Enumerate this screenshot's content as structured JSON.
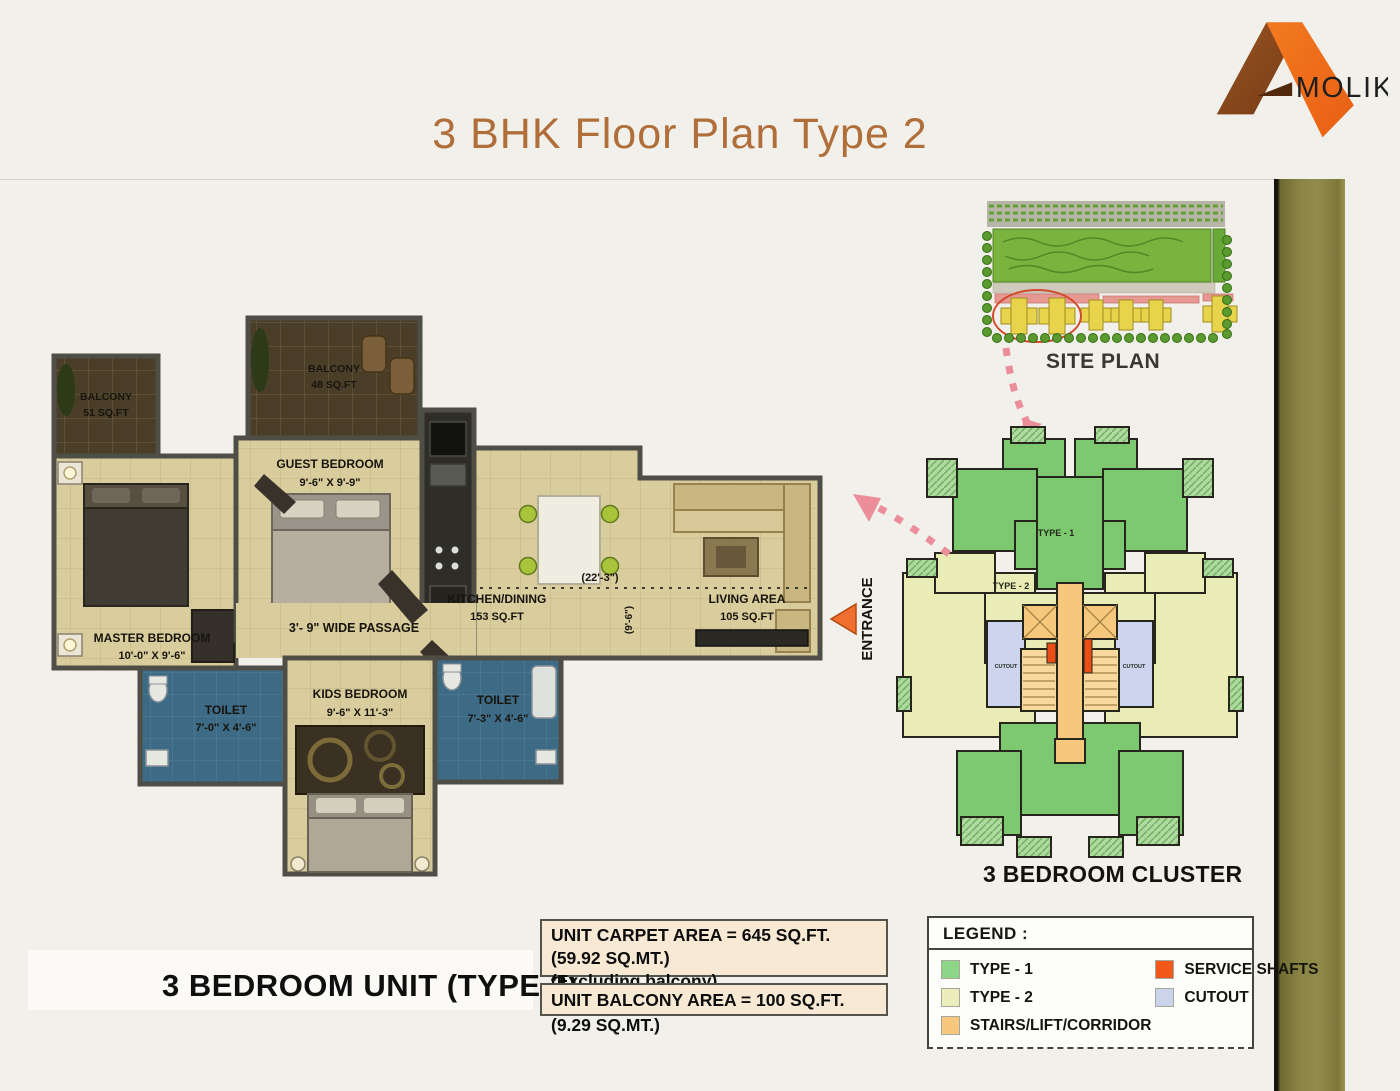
{
  "header": {
    "title": "3 BHK Floor Plan Type 2",
    "brand": "MOLIK"
  },
  "floor_plan": {
    "unit_label": "3 BEDROOM UNIT (TYPE 2)",
    "entrance_label": "ENTRANCE",
    "passage_label": "3'- 9\" WIDE PASSAGE",
    "width_dim": "(22'-3\")",
    "depth_dim": "(9'-6\")",
    "rooms": {
      "balcony_left": {
        "name": "BALCONY",
        "size": "51 SQ.FT"
      },
      "balcony_top": {
        "name": "BALCONY",
        "size": "48 SQ.FT"
      },
      "master_bedroom": {
        "name": "MASTER BEDROOM",
        "size": "10'-0\" X 9'-6\""
      },
      "guest_bedroom": {
        "name": "GUEST BEDROOM",
        "size": "9'-6\" X 9'-9\""
      },
      "kitchen_dining": {
        "name": "KITCHEN/DINING",
        "size": "153 SQ.FT"
      },
      "living_area": {
        "name": "LIVING AREA",
        "size": "105 SQ.FT"
      },
      "toilet_left": {
        "name": "TOILET",
        "size": "7'-0\" X 4'-6\""
      },
      "kids_bedroom": {
        "name": "KIDS BEDROOM",
        "size": "9'-6\" X 11'-3\""
      },
      "toilet_right": {
        "name": "TOILET",
        "size": "7'-3\" X 4'-6\""
      }
    }
  },
  "site_plan": {
    "label": "SITE PLAN"
  },
  "cluster": {
    "label": "3 BEDROOM CLUSTER",
    "type1_label": "TYPE - 1",
    "type2_label": "TYPE - 2",
    "cutout_label": "CUTOUT"
  },
  "area_info": {
    "carpet_area": "UNIT CARPET AREA  = 645 SQ.FT. (59.92 SQ.MT.)",
    "carpet_note": "(Excluding balcony)",
    "balcony_area": "UNIT BALCONY AREA = 100 SQ.FT. (9.29 SQ.MT.)"
  },
  "legend": {
    "title": "LEGEND :",
    "items": [
      {
        "label": "TYPE - 1",
        "color": "#8ed687"
      },
      {
        "label": "TYPE - 2",
        "color": "#ebeeba"
      },
      {
        "label": "STAIRS/LIFT/CORRIDOR",
        "color": "#f6c87c"
      },
      {
        "label": "SERVICE SHAFTS",
        "color": "#f2581a"
      },
      {
        "label": "CUTOUT",
        "color": "#ccd4ec"
      }
    ]
  }
}
